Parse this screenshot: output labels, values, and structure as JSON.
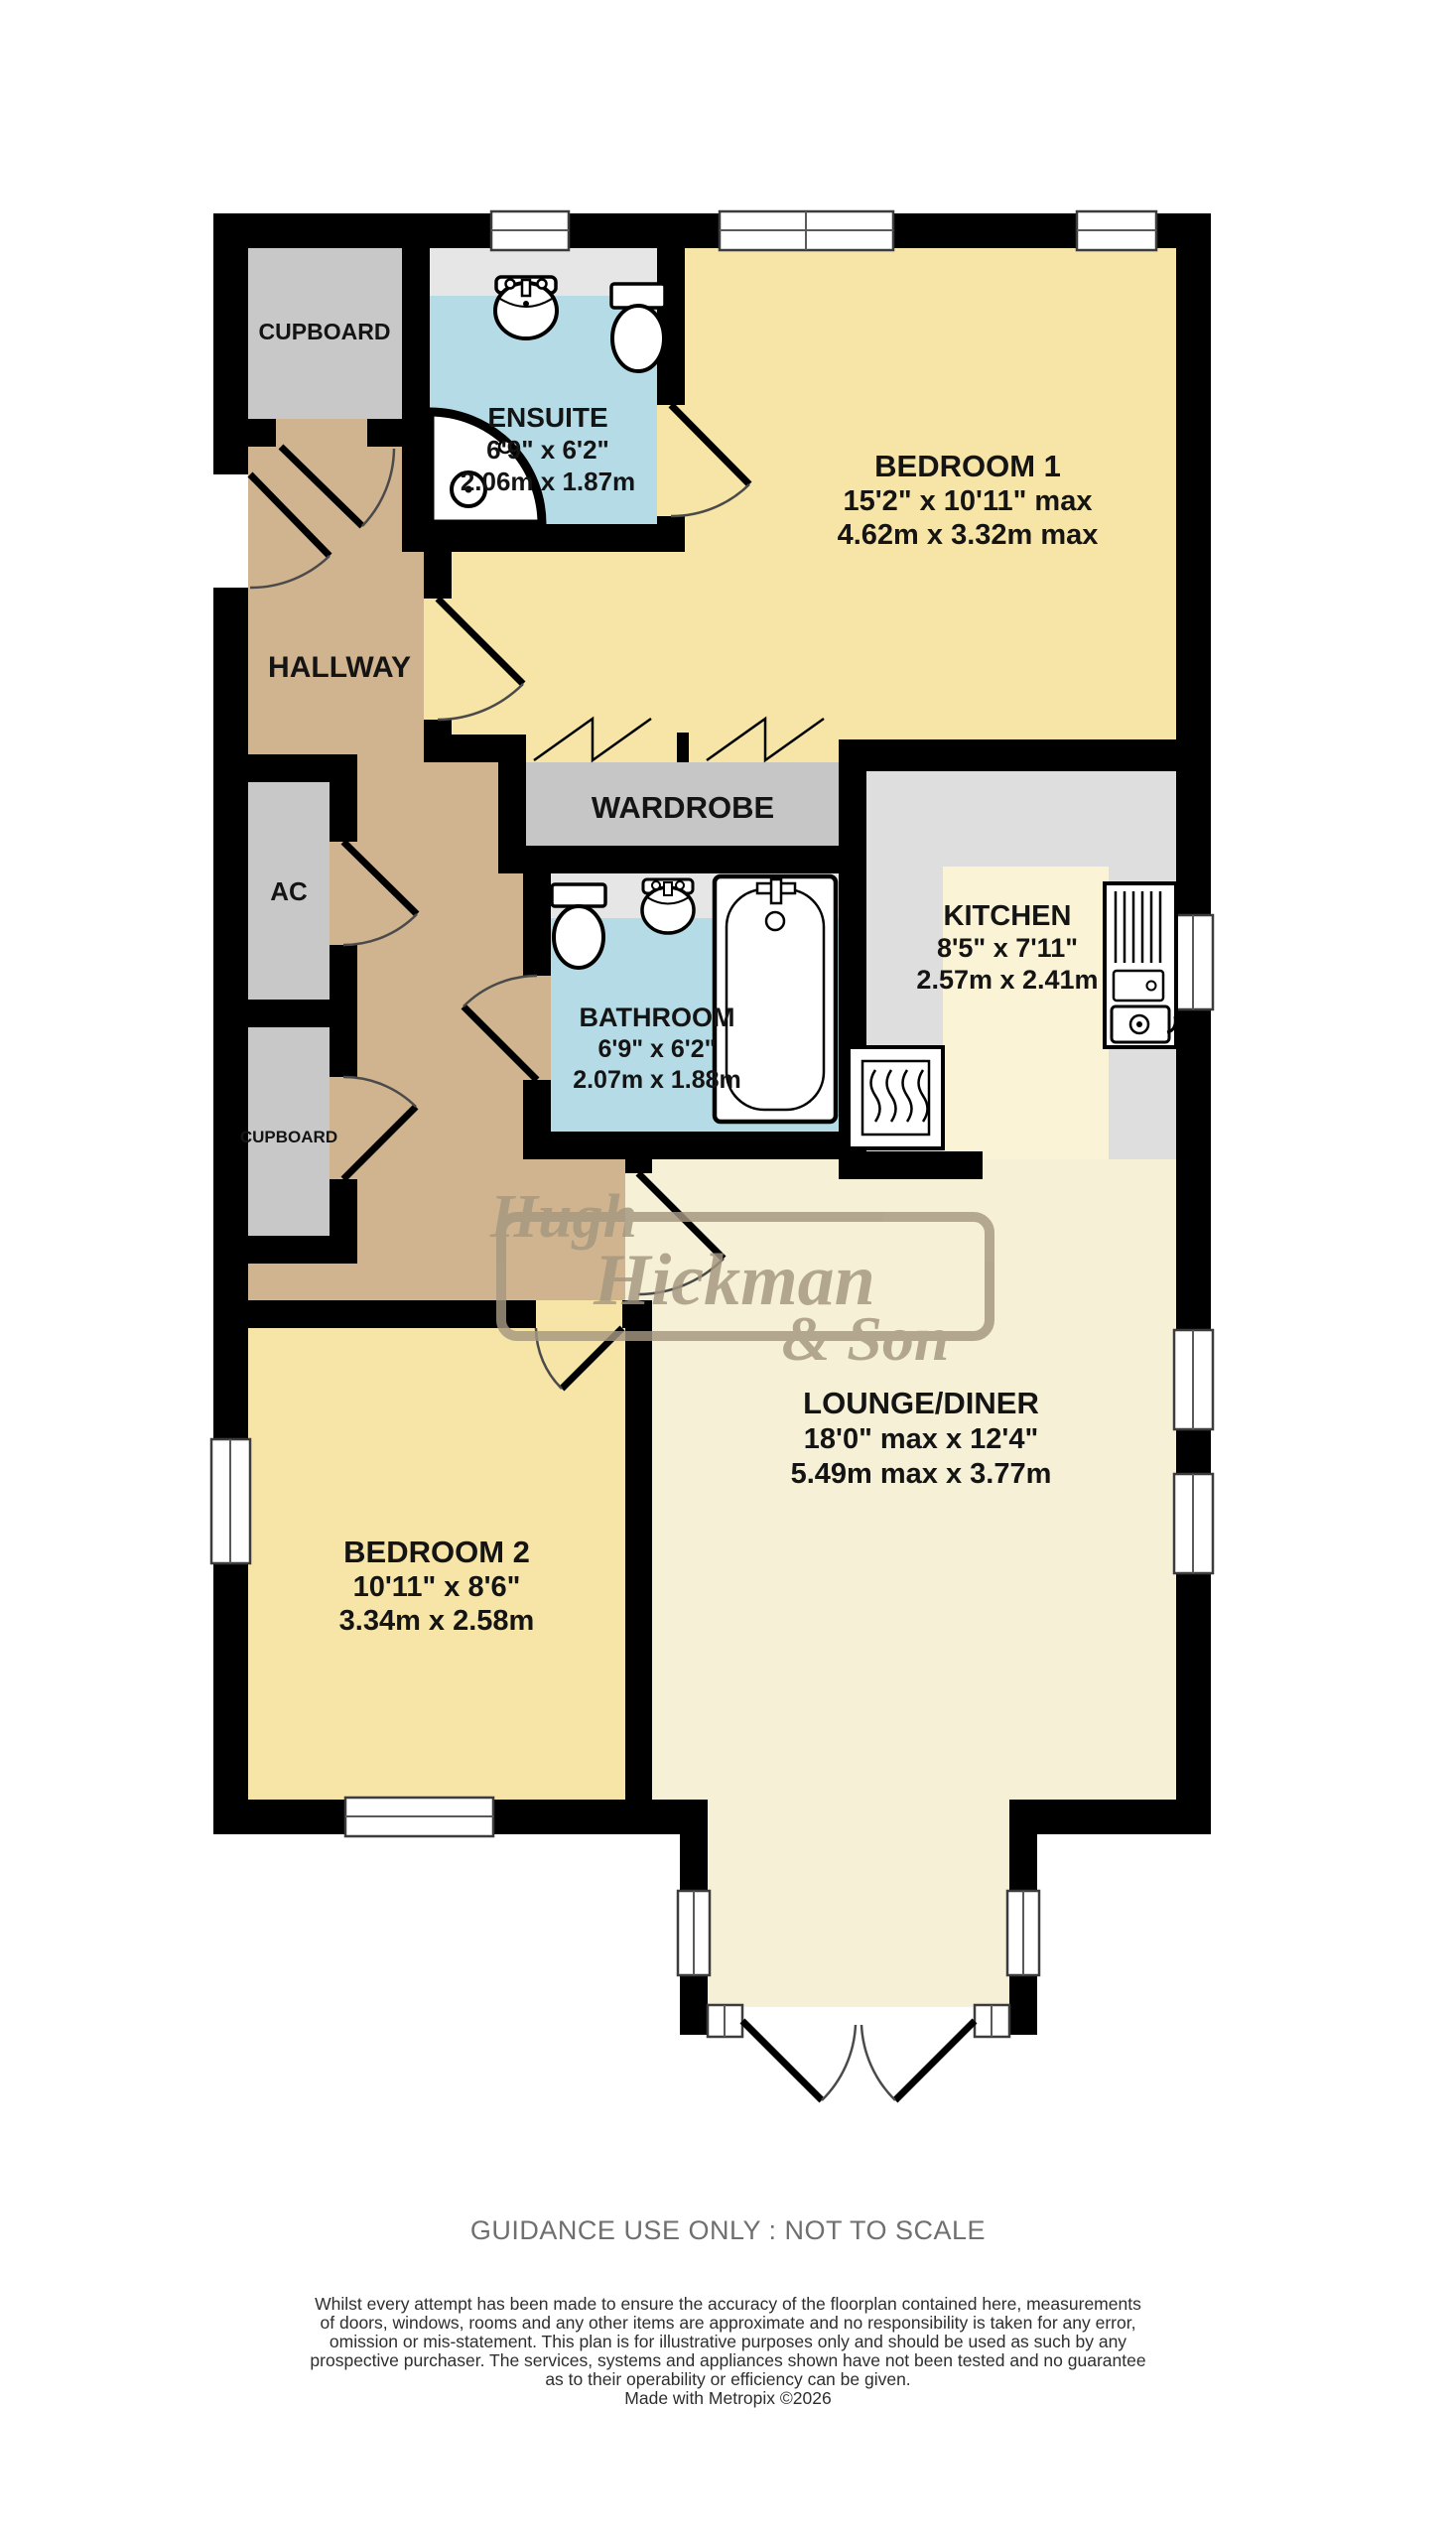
{
  "palette": {
    "wall": "#000000",
    "bedroom_floor": "#f6e5a6",
    "lounge_floor": "#f6f0d6",
    "hallway_floor": "#d0b48f",
    "wet_room_floor": "#b5dce6",
    "cupboard_floor": "#c8c8c8",
    "kitchen_counter": "#dedede",
    "kitchen_floor": "#faf3d6",
    "vanity_strip": "#e6e6e6",
    "watermark": "#a59780"
  },
  "rooms": {
    "cupboard_top": {
      "label": "CUPBOARD"
    },
    "ensuite": {
      "label": "ENSUITE",
      "imperial": "6'9\"  x 6'2\"",
      "metric": "2.06m  x 1.87m"
    },
    "bedroom1": {
      "label": "BEDROOM 1",
      "imperial": "15'2\"  x 10'11\" max",
      "metric": "4.62m  x 3.32m max"
    },
    "hallway": {
      "label": "HALLWAY"
    },
    "wardrobe": {
      "label": "WARDROBE"
    },
    "ac": {
      "label": "AC"
    },
    "kitchen": {
      "label": "KITCHEN",
      "imperial": "8'5\"  x 7'11\"",
      "metric": "2.57m  x 2.41m"
    },
    "bathroom": {
      "label": "BATHROOM",
      "imperial": "6'9\"  x 6'2\"",
      "metric": "2.07m  x 1.88m"
    },
    "cupboard_mid": {
      "label": "CUPBOARD"
    },
    "lounge": {
      "label": "LOUNGE/DINER",
      "imperial": "18'0\" max x 12'4\"",
      "metric": "5.49m max x 3.77m"
    },
    "bedroom2": {
      "label": "BEDROOM 2",
      "imperial": "10'11\"  x 8'6\"",
      "metric": "3.34m  x 2.58m"
    }
  },
  "watermark": {
    "line1": "Hugh",
    "line2": "Hickman",
    "line3": "& Son"
  },
  "footer": {
    "guidance": "GUIDANCE USE ONLY : NOT TO SCALE",
    "disclaimer": [
      "Whilst every attempt has been made to ensure the accuracy of the floorplan contained here, measurements",
      "of doors, windows, rooms and any other items are approximate and no responsibility is taken for any error,",
      "omission or mis-statement. This plan is for illustrative purposes only and should be used as such by any",
      "prospective purchaser. The services, systems and appliances shown have not been tested and no guarantee",
      "as to their operability or efficiency can be given."
    ],
    "credit": "Made with Metropix ©2026"
  }
}
